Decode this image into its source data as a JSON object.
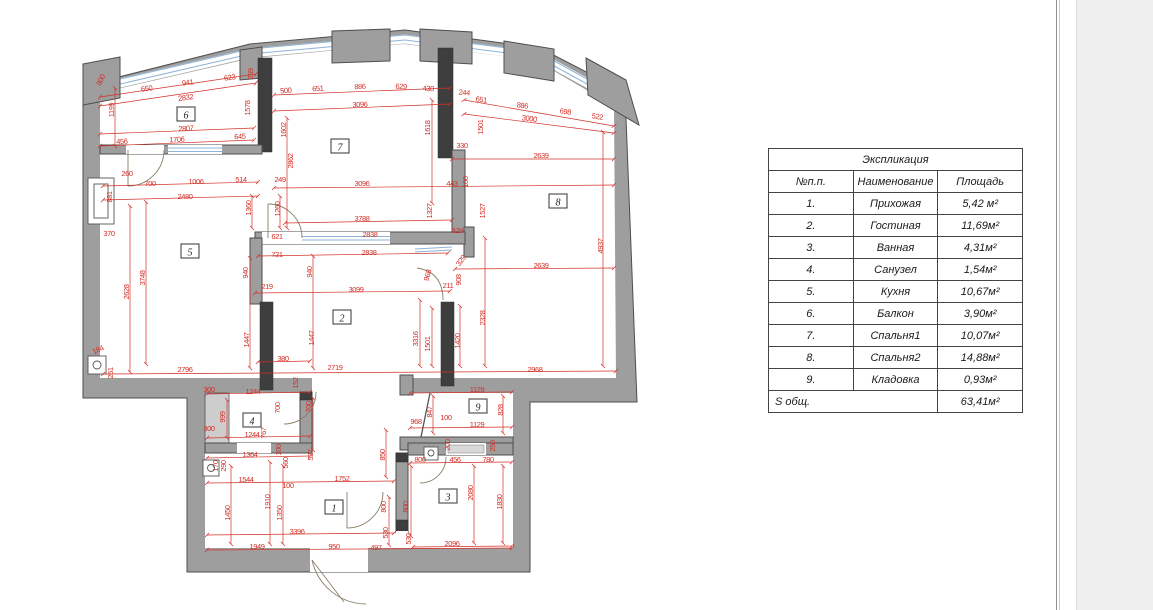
{
  "plan": {
    "wall_color": "#9e9e9e",
    "dark_wall_color": "#3e3e3e",
    "dim_color": "#d32f27",
    "glass_color": "#8fb3d9",
    "rooms": [
      {
        "num": "1",
        "x": 334,
        "y": 508
      },
      {
        "num": "2",
        "x": 342,
        "y": 318
      },
      {
        "num": "3",
        "x": 448,
        "y": 497
      },
      {
        "num": "4",
        "x": 252,
        "y": 421
      },
      {
        "num": "5",
        "x": 190,
        "y": 252
      },
      {
        "num": "6",
        "x": 186,
        "y": 115
      },
      {
        "num": "7",
        "x": 340,
        "y": 147
      },
      {
        "num": "8",
        "x": 558,
        "y": 202
      },
      {
        "num": "9",
        "x": 478,
        "y": 407
      }
    ],
    "dimensions": [
      [
        "800",
        103,
        81,
        -65
      ],
      [
        "650",
        147,
        91,
        -8
      ],
      [
        "941",
        188,
        85,
        -8
      ],
      [
        "623",
        230,
        80,
        -8
      ],
      [
        "259",
        253,
        74,
        -90
      ],
      [
        "2832",
        186,
        100,
        -8
      ],
      [
        "1578",
        250,
        108,
        -90
      ],
      [
        "1199",
        114,
        110,
        -90
      ],
      [
        "2807",
        186,
        131,
        -3
      ],
      [
        "456",
        122,
        144,
        -3
      ],
      [
        "1706",
        177,
        142,
        -3
      ],
      [
        "645",
        240,
        139,
        -3
      ],
      [
        "260",
        127,
        176
      ],
      [
        "700",
        150,
        186
      ],
      [
        "1006",
        196,
        184
      ],
      [
        "514",
        241,
        182
      ],
      [
        "2480",
        185,
        199
      ],
      [
        "881",
        112,
        197,
        -90
      ],
      [
        "370",
        109,
        236
      ],
      [
        "2628",
        129,
        292,
        -90
      ],
      [
        "3748",
        145,
        278,
        -90
      ],
      [
        "184",
        99,
        352,
        -25
      ],
      [
        "261",
        113,
        373,
        -90
      ],
      [
        "2796",
        185,
        372
      ],
      [
        "500",
        286,
        93,
        -5
      ],
      [
        "651",
        318,
        91,
        -4
      ],
      [
        "886",
        360,
        89,
        -2
      ],
      [
        "629",
        401,
        89,
        2
      ],
      [
        "430",
        428,
        91,
        4
      ],
      [
        "3096",
        360,
        107,
        -2
      ],
      [
        "1602",
        286,
        130,
        -90
      ],
      [
        "1618",
        430,
        128,
        -90
      ],
      [
        "2862",
        293,
        161,
        -90
      ],
      [
        "249",
        280,
        182
      ],
      [
        "3096",
        362,
        186
      ],
      [
        "443",
        452,
        186
      ],
      [
        "100",
        468,
        182,
        -90
      ],
      [
        "1260",
        280,
        209,
        -90
      ],
      [
        "1360",
        251,
        208,
        -90
      ],
      [
        "1327",
        432,
        211,
        -90
      ],
      [
        "3788",
        362,
        221
      ],
      [
        "2838",
        370,
        237
      ],
      [
        "621",
        277,
        239
      ],
      [
        "2838",
        369,
        255
      ],
      [
        "721",
        277,
        257
      ],
      [
        "940",
        248,
        273,
        -90
      ],
      [
        "940",
        312,
        272,
        -90
      ],
      [
        "219",
        267,
        289
      ],
      [
        "3099",
        356,
        292
      ],
      [
        "244",
        464,
        95,
        5
      ],
      [
        "651",
        481,
        102,
        7
      ],
      [
        "886",
        522,
        108,
        7
      ],
      [
        "698",
        565,
        114,
        8
      ],
      [
        "522",
        597,
        119,
        9
      ],
      [
        "3000",
        529,
        121,
        7
      ],
      [
        "1501",
        483,
        127,
        -90
      ],
      [
        "330",
        462,
        148
      ],
      [
        "2639",
        541,
        158
      ],
      [
        "1527",
        485,
        211,
        -90
      ],
      [
        "329",
        457,
        233
      ],
      [
        "329",
        463,
        262,
        -55
      ],
      [
        "908",
        461,
        280,
        -90
      ],
      [
        "968",
        430,
        276,
        -75
      ],
      [
        "211",
        448,
        288
      ],
      [
        "2639",
        541,
        268
      ],
      [
        "2328",
        485,
        318,
        -90
      ],
      [
        "4937",
        603,
        246,
        -90
      ],
      [
        "3316",
        418,
        339,
        -90
      ],
      [
        "1501",
        430,
        344,
        -90
      ],
      [
        "1420",
        460,
        341,
        -90
      ],
      [
        "2968",
        535,
        372
      ],
      [
        "1447",
        249,
        340,
        -90
      ],
      [
        "1447",
        314,
        338,
        -90
      ],
      [
        "380",
        283,
        361
      ],
      [
        "2719",
        335,
        370
      ],
      [
        "152",
        298,
        383,
        -90
      ],
      [
        "300",
        209,
        392
      ],
      [
        "1244",
        253,
        394
      ],
      [
        "999",
        225,
        417,
        -90
      ],
      [
        "300",
        209,
        431
      ],
      [
        "1244",
        252,
        437
      ],
      [
        "767",
        266,
        433,
        -90
      ],
      [
        "700",
        280,
        408,
        -90
      ],
      [
        "700",
        311,
        407,
        -90
      ],
      [
        "170",
        218,
        466,
        -90
      ],
      [
        "290",
        226,
        466,
        -90
      ],
      [
        "1364",
        250,
        457
      ],
      [
        "100",
        281,
        450,
        -90
      ],
      [
        "560",
        288,
        463,
        -90
      ],
      [
        "527",
        313,
        455,
        -90
      ],
      [
        "1544",
        246,
        482
      ],
      [
        "100",
        288,
        488
      ],
      [
        "1910",
        270,
        502,
        -90
      ],
      [
        "1450",
        230,
        513,
        -90
      ],
      [
        "1350",
        282,
        513,
        -90
      ],
      [
        "1752",
        342,
        481
      ],
      [
        "3396",
        297,
        534
      ],
      [
        "1949",
        257,
        549
      ],
      [
        "950",
        334,
        549
      ],
      [
        "497",
        376,
        550
      ],
      [
        "850",
        385,
        455,
        -90
      ],
      [
        "800",
        386,
        507,
        -90
      ],
      [
        "800",
        408,
        507,
        -90
      ],
      [
        "530",
        388,
        533,
        -90
      ],
      [
        "530",
        411,
        539,
        -90
      ],
      [
        "968",
        416,
        424
      ],
      [
        "100",
        446,
        420
      ],
      [
        "1129",
        477,
        392
      ],
      [
        "847",
        432,
        412,
        -90
      ],
      [
        "828",
        503,
        410,
        -90
      ],
      [
        "1129",
        477,
        427
      ],
      [
        "200",
        450,
        445,
        -90
      ],
      [
        "250",
        495,
        446,
        -90
      ],
      [
        "800",
        420,
        462
      ],
      [
        "456",
        455,
        462
      ],
      [
        "780",
        488,
        462
      ],
      [
        "2080",
        473,
        493,
        -90
      ],
      [
        "1830",
        502,
        502,
        -90
      ],
      [
        "2096",
        452,
        546
      ]
    ]
  },
  "table": {
    "title": "Экспликация",
    "headers": [
      "№п.п.",
      "Наименование",
      "Площадь"
    ],
    "rows": [
      [
        "1.",
        "Прихожая",
        "5,42 м²"
      ],
      [
        "2.",
        "Гостиная",
        "11,69м²"
      ],
      [
        "3.",
        "Ванная",
        "4,31м²"
      ],
      [
        "4.",
        "Санузел",
        "1,54м²"
      ],
      [
        "5.",
        "Кухня",
        "10,67м²"
      ],
      [
        "6.",
        "Балкон",
        "3,90м²"
      ],
      [
        "7.",
        "Спальня1",
        "10,07м²"
      ],
      [
        "8.",
        "Спальня2",
        "14,88м²"
      ],
      [
        "9.",
        "Кладовка",
        "0,93м²"
      ]
    ],
    "footer": [
      "S общ.",
      "63,41м²"
    ]
  }
}
